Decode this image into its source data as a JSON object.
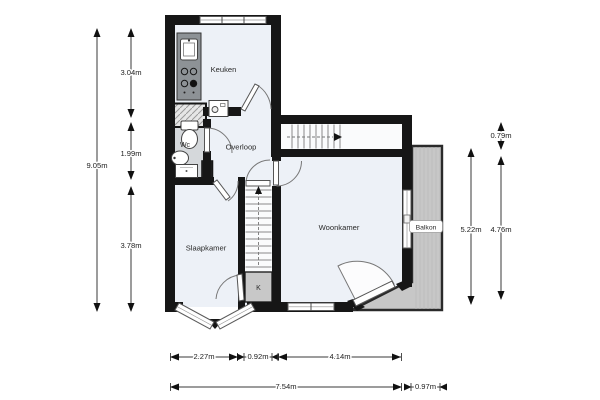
{
  "plan_type": "floorplan",
  "colors": {
    "wall": "#161616",
    "floor": "#edf1f7",
    "stair_floor": "#fafbfc",
    "wet_floor": "#d5d8db",
    "gray_area": "#c7c7c7",
    "closet_fill": "#c8c8c8",
    "counter": "#8d9296"
  },
  "rooms": [
    {
      "id": "keuken",
      "label": "Keuken"
    },
    {
      "id": "overloop",
      "label": "Overloop"
    },
    {
      "id": "wc",
      "label": "Wc"
    },
    {
      "id": "slaapkamer",
      "label": "Slaapkamer"
    },
    {
      "id": "woonkamer",
      "label": "Woonkamer"
    },
    {
      "id": "balkon",
      "label": "Balkon"
    },
    {
      "id": "kast",
      "label": "K"
    }
  ],
  "dimensions": {
    "left_total": "9.05m",
    "left_segments": [
      "3.04m",
      "1.99m",
      "3.78m"
    ],
    "right_total": "5.22m",
    "right_top": "0.79m",
    "right_inner": "4.76m",
    "bottom_segments": [
      "2.27m",
      "0.92m",
      "4.14m"
    ],
    "bottom_total": "7.54m",
    "bottom_right": "0.97m"
  }
}
